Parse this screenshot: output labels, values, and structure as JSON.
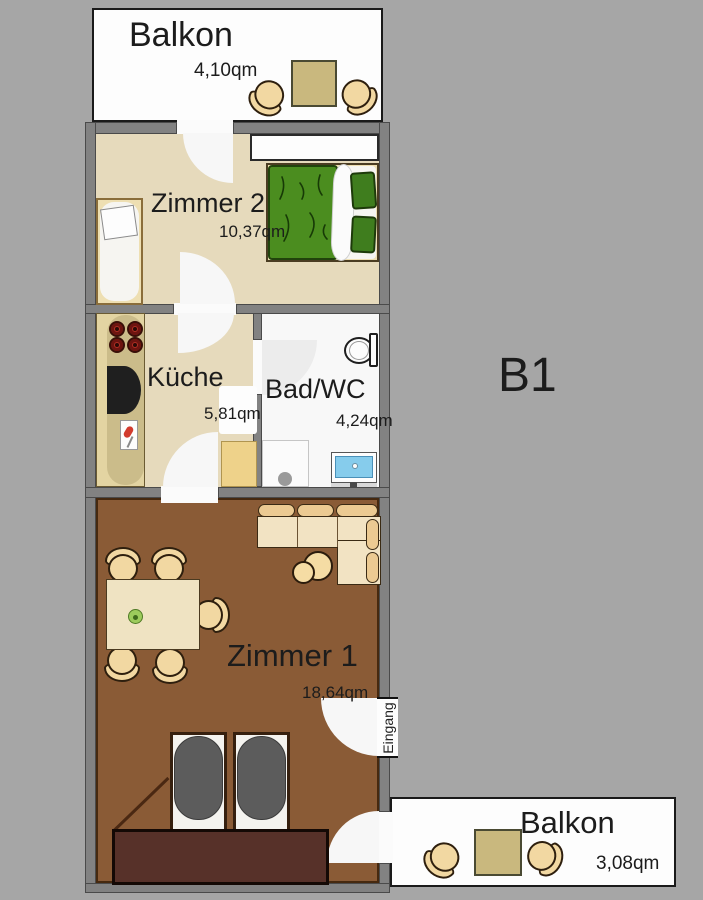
{
  "plan": {
    "unit_label": "B1",
    "entrance_label": "Eingang"
  },
  "rooms": {
    "balcony_top": {
      "name": "Balkon",
      "area": "4,10qm"
    },
    "zimmer2": {
      "name": "Zimmer 2",
      "area": "10,37qm"
    },
    "kueche": {
      "name": "Küche",
      "area": "5,81qm"
    },
    "bad": {
      "name": "Bad/WC",
      "area": "4,24qm"
    },
    "zimmer1": {
      "name": "Zimmer 1",
      "area": "18,64qm"
    },
    "balcony_bottom": {
      "name": "Balkon",
      "area": "3,08qm"
    }
  },
  "colors": {
    "background_gray": "#a6a6a6",
    "wall_gray": "#828282",
    "floor_beige": "#e6dabc",
    "floor_brown": "#8a5b36",
    "balcony_white": "#fdfdfd",
    "duvet_green": "#4b8d1f",
    "furniture_tan": "#f2d8a2",
    "table_tan": "#c9b87e",
    "bed_duvet_gray": "#5c5c5c",
    "sideboard_brown": "#573129",
    "basin_blue": "#86ccec"
  }
}
